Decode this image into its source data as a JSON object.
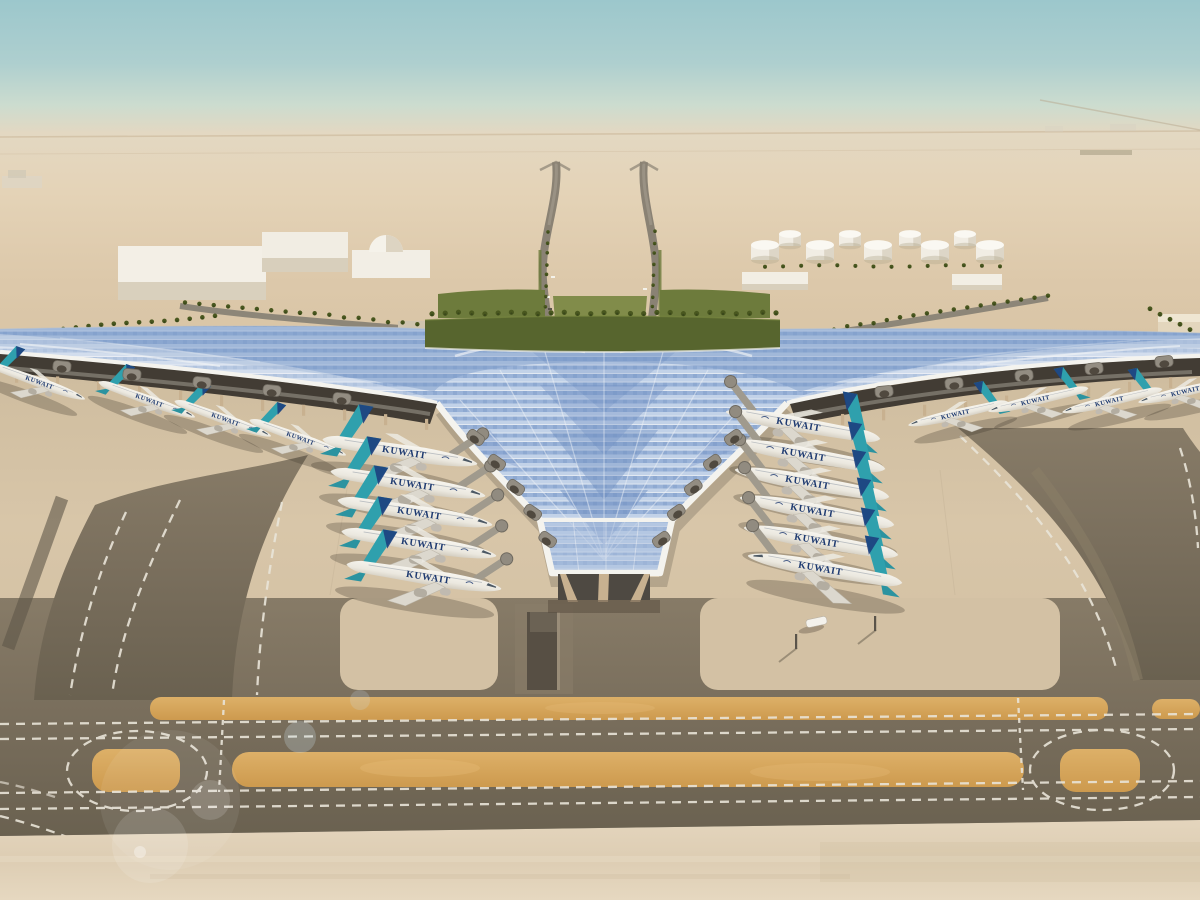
{
  "meta": {
    "title": "Aerial rendering of Kuwait International Airport new terminal in the desert",
    "type": "architectural-rendering",
    "time_of_day": "day"
  },
  "scene": {
    "airline": {
      "label": "KUWAIT",
      "tail_teal": "#2fa0ad",
      "tail_navy": "#1d3f7e",
      "titles_navy": "#1e3a70",
      "fuselage_white": "#f2efe7"
    },
    "terminal": {
      "roof_base": "#dce4ee",
      "pv_blue": "#8aa7d2",
      "pv_blue_deep": "#6f90c2",
      "fascia_white": "#f4f3ee",
      "column_tan": "#c8b190",
      "under_shadow": "#423c34"
    },
    "environment": {
      "sky_top": "#9fc9ce",
      "sky_horizon": "#e5d6bf",
      "desert_sand": "#decaab",
      "greenery": "#57652e",
      "palm_green": "#49571f",
      "building_white": "#f2eee5"
    },
    "ground": {
      "apron_concrete": "#d6c4a7",
      "taxiway_dark": "#7c7160",
      "marking_white": "#e9e4d8",
      "island_orange": "#d7a55b",
      "foreground_sand": "#e0d1b8"
    },
    "aircraft": {
      "label": "KUWAIT",
      "count": 19,
      "groups": [
        {
          "name": "left-concourse",
          "dir": 1,
          "rot": 9,
          "scale": 1.22,
          "bridge": true,
          "show_label": true,
          "planes": [
            [
              402,
              452
            ],
            [
              410,
              484
            ],
            [
              417,
              513
            ],
            [
              421,
              544
            ],
            [
              426,
              577
            ]
          ]
        },
        {
          "name": "right-concourse",
          "dir": -1,
          "rot": 10,
          "scale": 1.22,
          "bridge": true,
          "show_label": true,
          "planes": [
            [
              801,
              425
            ],
            [
              806,
              455
            ],
            [
              810,
              483
            ],
            [
              815,
              511
            ],
            [
              819,
              541
            ],
            [
              823,
              569
            ]
          ]
        },
        {
          "name": "far-left-pier",
          "dir": 1,
          "rot": 20,
          "scale": 0.8,
          "bridge": false,
          "show_label": true,
          "planes": [
            [
              38,
              382
            ],
            [
              148,
              400
            ],
            [
              224,
              419
            ],
            [
              299,
              438
            ]
          ]
        },
        {
          "name": "far-right-pier",
          "dir": -1,
          "rot": -13,
          "scale": 0.8,
          "bridge": false,
          "show_label": true,
          "planes": [
            [
              957,
              414
            ],
            [
              1037,
              400
            ],
            [
              1111,
              401
            ],
            [
              1187,
              391
            ]
          ]
        }
      ]
    },
    "vehicles": {
      "apron_bus": [
        816,
        622
      ]
    }
  }
}
